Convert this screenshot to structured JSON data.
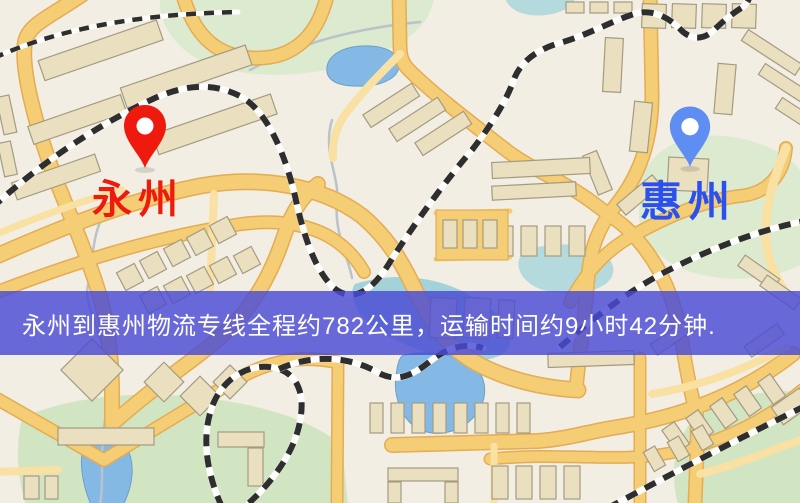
{
  "map": {
    "markers": [
      {
        "name": "origin",
        "label": "永州",
        "pin_color": "#ee1a0e",
        "pin_inner_color": "#ffffff",
        "label_color": "#ee1a0e",
        "icon": "location-pin-icon"
      },
      {
        "name": "destination",
        "label": "惠州",
        "pin_color": "#5f8ef3",
        "pin_inner_color": "#ffffff",
        "label_color": "#2b50ee",
        "icon": "location-pin-icon"
      }
    ]
  },
  "banner": {
    "text": "永州到惠州物流专线全程约782公里，运输时间约9小时42分钟.",
    "background_color": "rgba(73,75,214,0.82)",
    "text_color": "#ffffff"
  },
  "palette": {
    "map_background": "#f2eee3",
    "road": "#f4cd74",
    "road_minor": "#f8e1a2",
    "building": "#eadfbf",
    "park": "#dcead0",
    "water": "#84b9e6",
    "railway": "#2e2e2e"
  }
}
